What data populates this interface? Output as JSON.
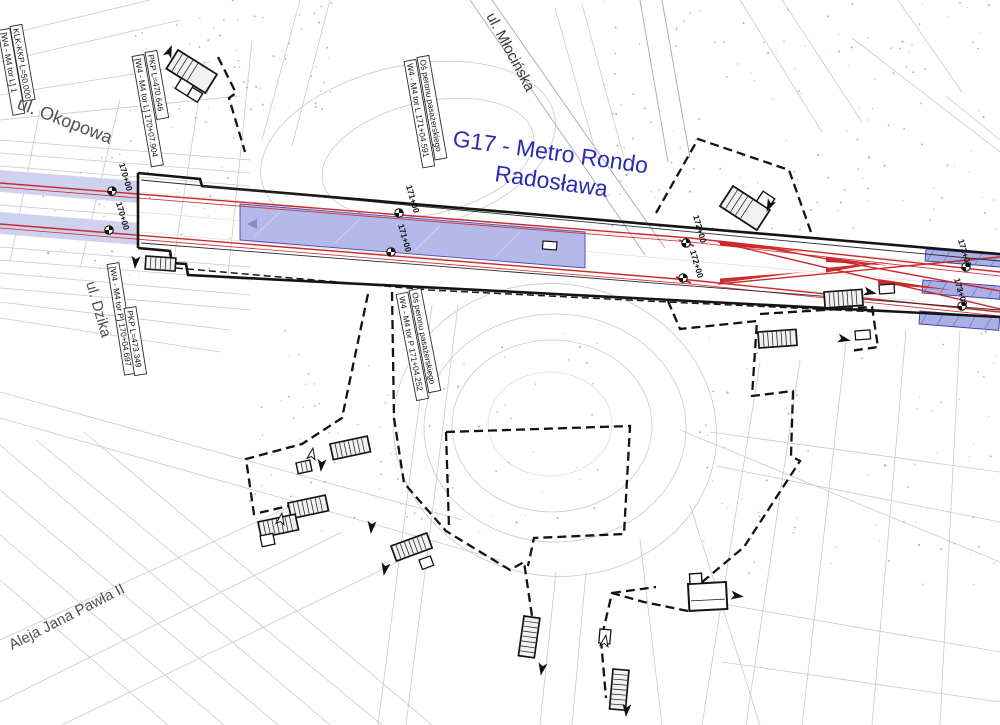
{
  "title": {
    "line1": "G17 - Metro Rondo",
    "line2": "Radosława"
  },
  "streets": {
    "okopowa": "ul. Okopowa",
    "dzika": "ul. Dzika",
    "mlocinska": "ul. Młocińska",
    "aleja_jana_pawla": "Aleja Jana Pawła II"
  },
  "boxed_labels": {
    "klk": "KLK-KKP L=50.000",
    "w4_edge": "[W4 - M4 tor L] 1",
    "pkp_l": "PKP  L=470.646",
    "w4_tor_l": "[W4 - M4 tor L] 170+07.904",
    "os_peronu": "Oś peronu pasażerskiego",
    "axis_tor_l": "W4 - M4 tor L 171+04.591",
    "w4_tor_p": "[W4 - M4 tor P] 170+04.697",
    "pkp_p": "PKP  L=473.349",
    "axis_tor_p": "W4 - M4 tor P 171+04.252"
  },
  "chainage": {
    "c170": "170+00",
    "c171": "171+00",
    "c172": "172+00",
    "c173": "173+00"
  },
  "colors": {
    "title_blue": "#2b2bb4",
    "track_red": "#cc2a2a",
    "platform_fill": "#b5b9ea",
    "band_fill": "#c9cdec",
    "structure_black": "#141414"
  }
}
